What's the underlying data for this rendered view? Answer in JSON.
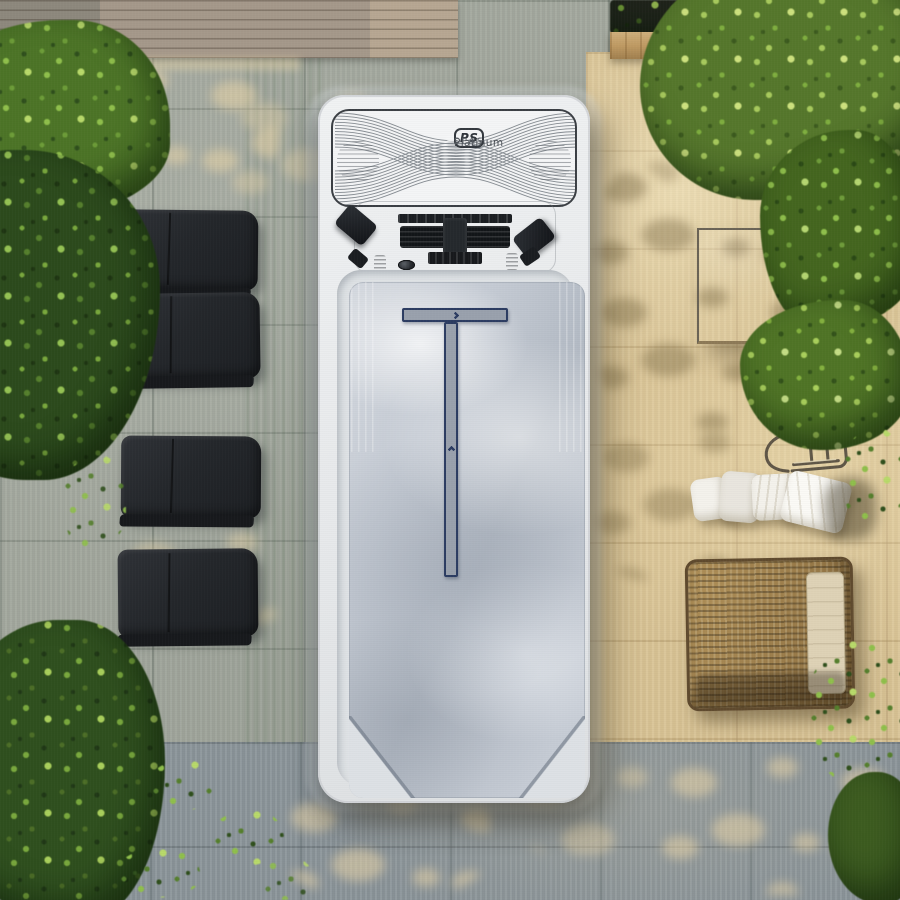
{
  "spa": {
    "brand": {
      "monogram": "PS",
      "name_line1": "Platinum",
      "name_line2": "SPAS"
    },
    "lane_marker": {
      "bar_chevrons": 4,
      "stem_chevrons": 11
    },
    "jet_count": 5,
    "step_ridges": 5
  },
  "patio": {
    "lounger_count": 4
  },
  "palette": {
    "paver_grey": "#a4a99f",
    "paver_tan": "#d9c496",
    "paver_blue_grey": "#8d969b",
    "spa_shell": "#eceeef",
    "spa_interior": "#c5ccd5",
    "lounger": "#25282c",
    "rail_navy": "#2c3c62",
    "foliage_bright": "#8fbf4b",
    "foliage_dark": "#2c4a1c",
    "wicker": "#9c7d49",
    "wood_deck": "#a5988a",
    "planter_wood": "#bf9a63"
  }
}
